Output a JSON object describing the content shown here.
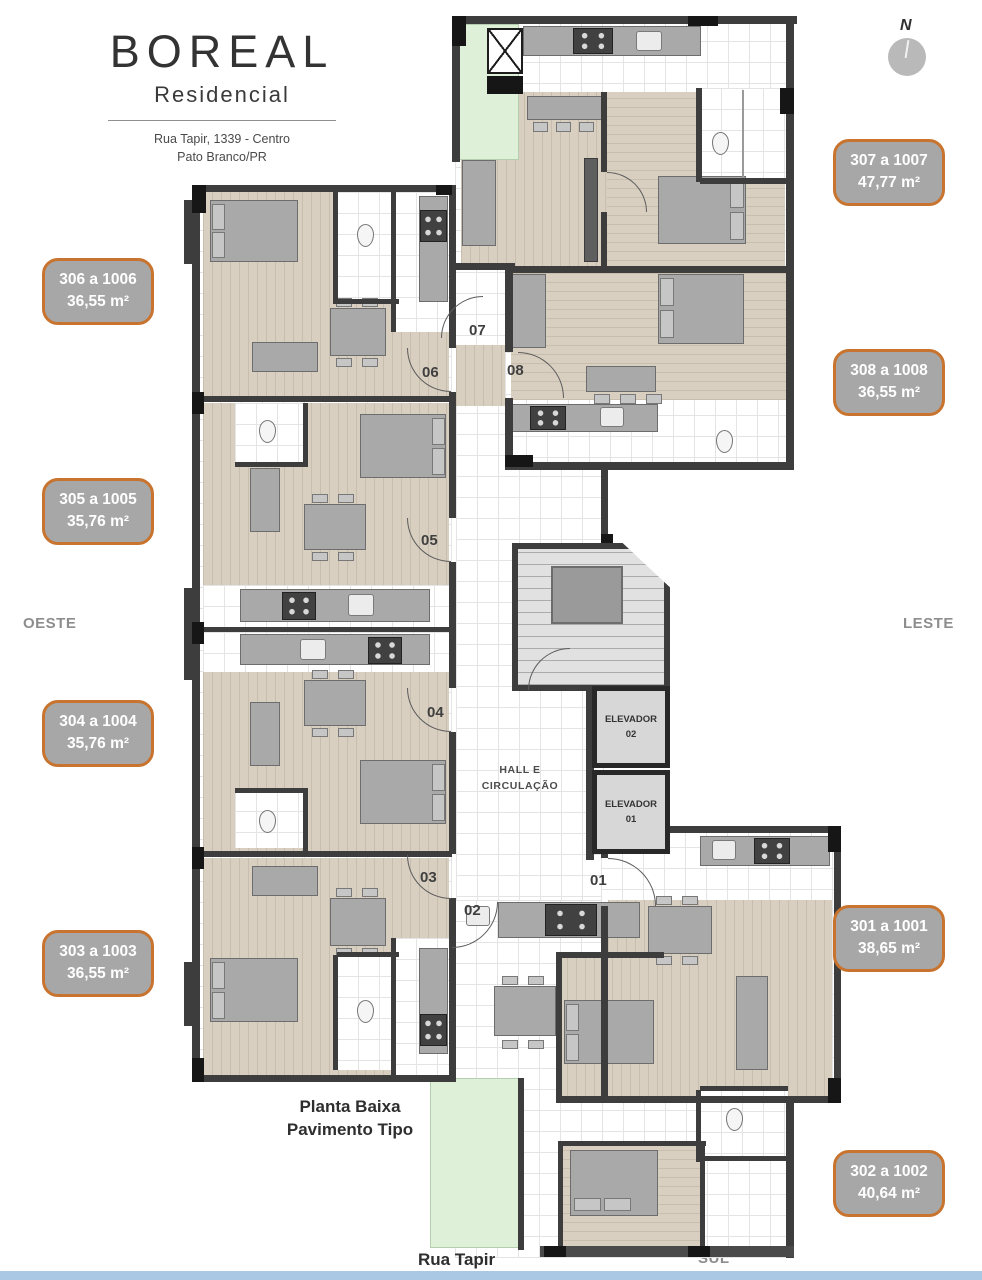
{
  "project": {
    "name": "BOREAL",
    "subtitle": "Residencial",
    "address1": "Rua Tapir, 1339 - Centro",
    "address2": "Pato Branco/PR"
  },
  "compass": {
    "letter": "N"
  },
  "directions": {
    "north": "NORTE",
    "south": "SUL",
    "east": "LESTE",
    "west": "OESTE"
  },
  "street": "Rua Tapir",
  "caption": {
    "line1": "Planta Baixa",
    "line2": "Pavimento Tipo"
  },
  "units": [
    {
      "label": "301 a 1001",
      "area": "38,65 m²"
    },
    {
      "label": "302 a 1002",
      "area": "40,64 m²"
    },
    {
      "label": "303 a 1003",
      "area": "36,55 m²"
    },
    {
      "label": "304 a 1004",
      "area": "35,76 m²"
    },
    {
      "label": "305 a 1005",
      "area": "35,76 m²"
    },
    {
      "label": "306 a 1006",
      "area": "36,55 m²"
    },
    {
      "label": "307 a 1007",
      "area": "47,77 m²"
    },
    {
      "label": "308 a 1008",
      "area": "36,55 m²"
    }
  ],
  "doors": [
    {
      "n": "01"
    },
    {
      "n": "02"
    },
    {
      "n": "03"
    },
    {
      "n": "04"
    },
    {
      "n": "05"
    },
    {
      "n": "06"
    },
    {
      "n": "07"
    },
    {
      "n": "08"
    }
  ],
  "core": {
    "hall_line1": "HALL E",
    "hall_line2": "CIRCULAÇÃO",
    "elevators": [
      {
        "line1": "ELEVADOR",
        "line2": "02"
      },
      {
        "line1": "ELEVADOR",
        "line2": "01"
      }
    ]
  },
  "colors": {
    "badge_fill": "#a7a7a7",
    "badge_border": "#c8742f",
    "wall": "#3d3d3d",
    "wood_floor": "#d8cfc0",
    "tile_floor": "#ffffff",
    "balcony_green": "#def0d8",
    "direction_text": "#8d8d8d",
    "bottom_bar": "#aac8e4"
  }
}
